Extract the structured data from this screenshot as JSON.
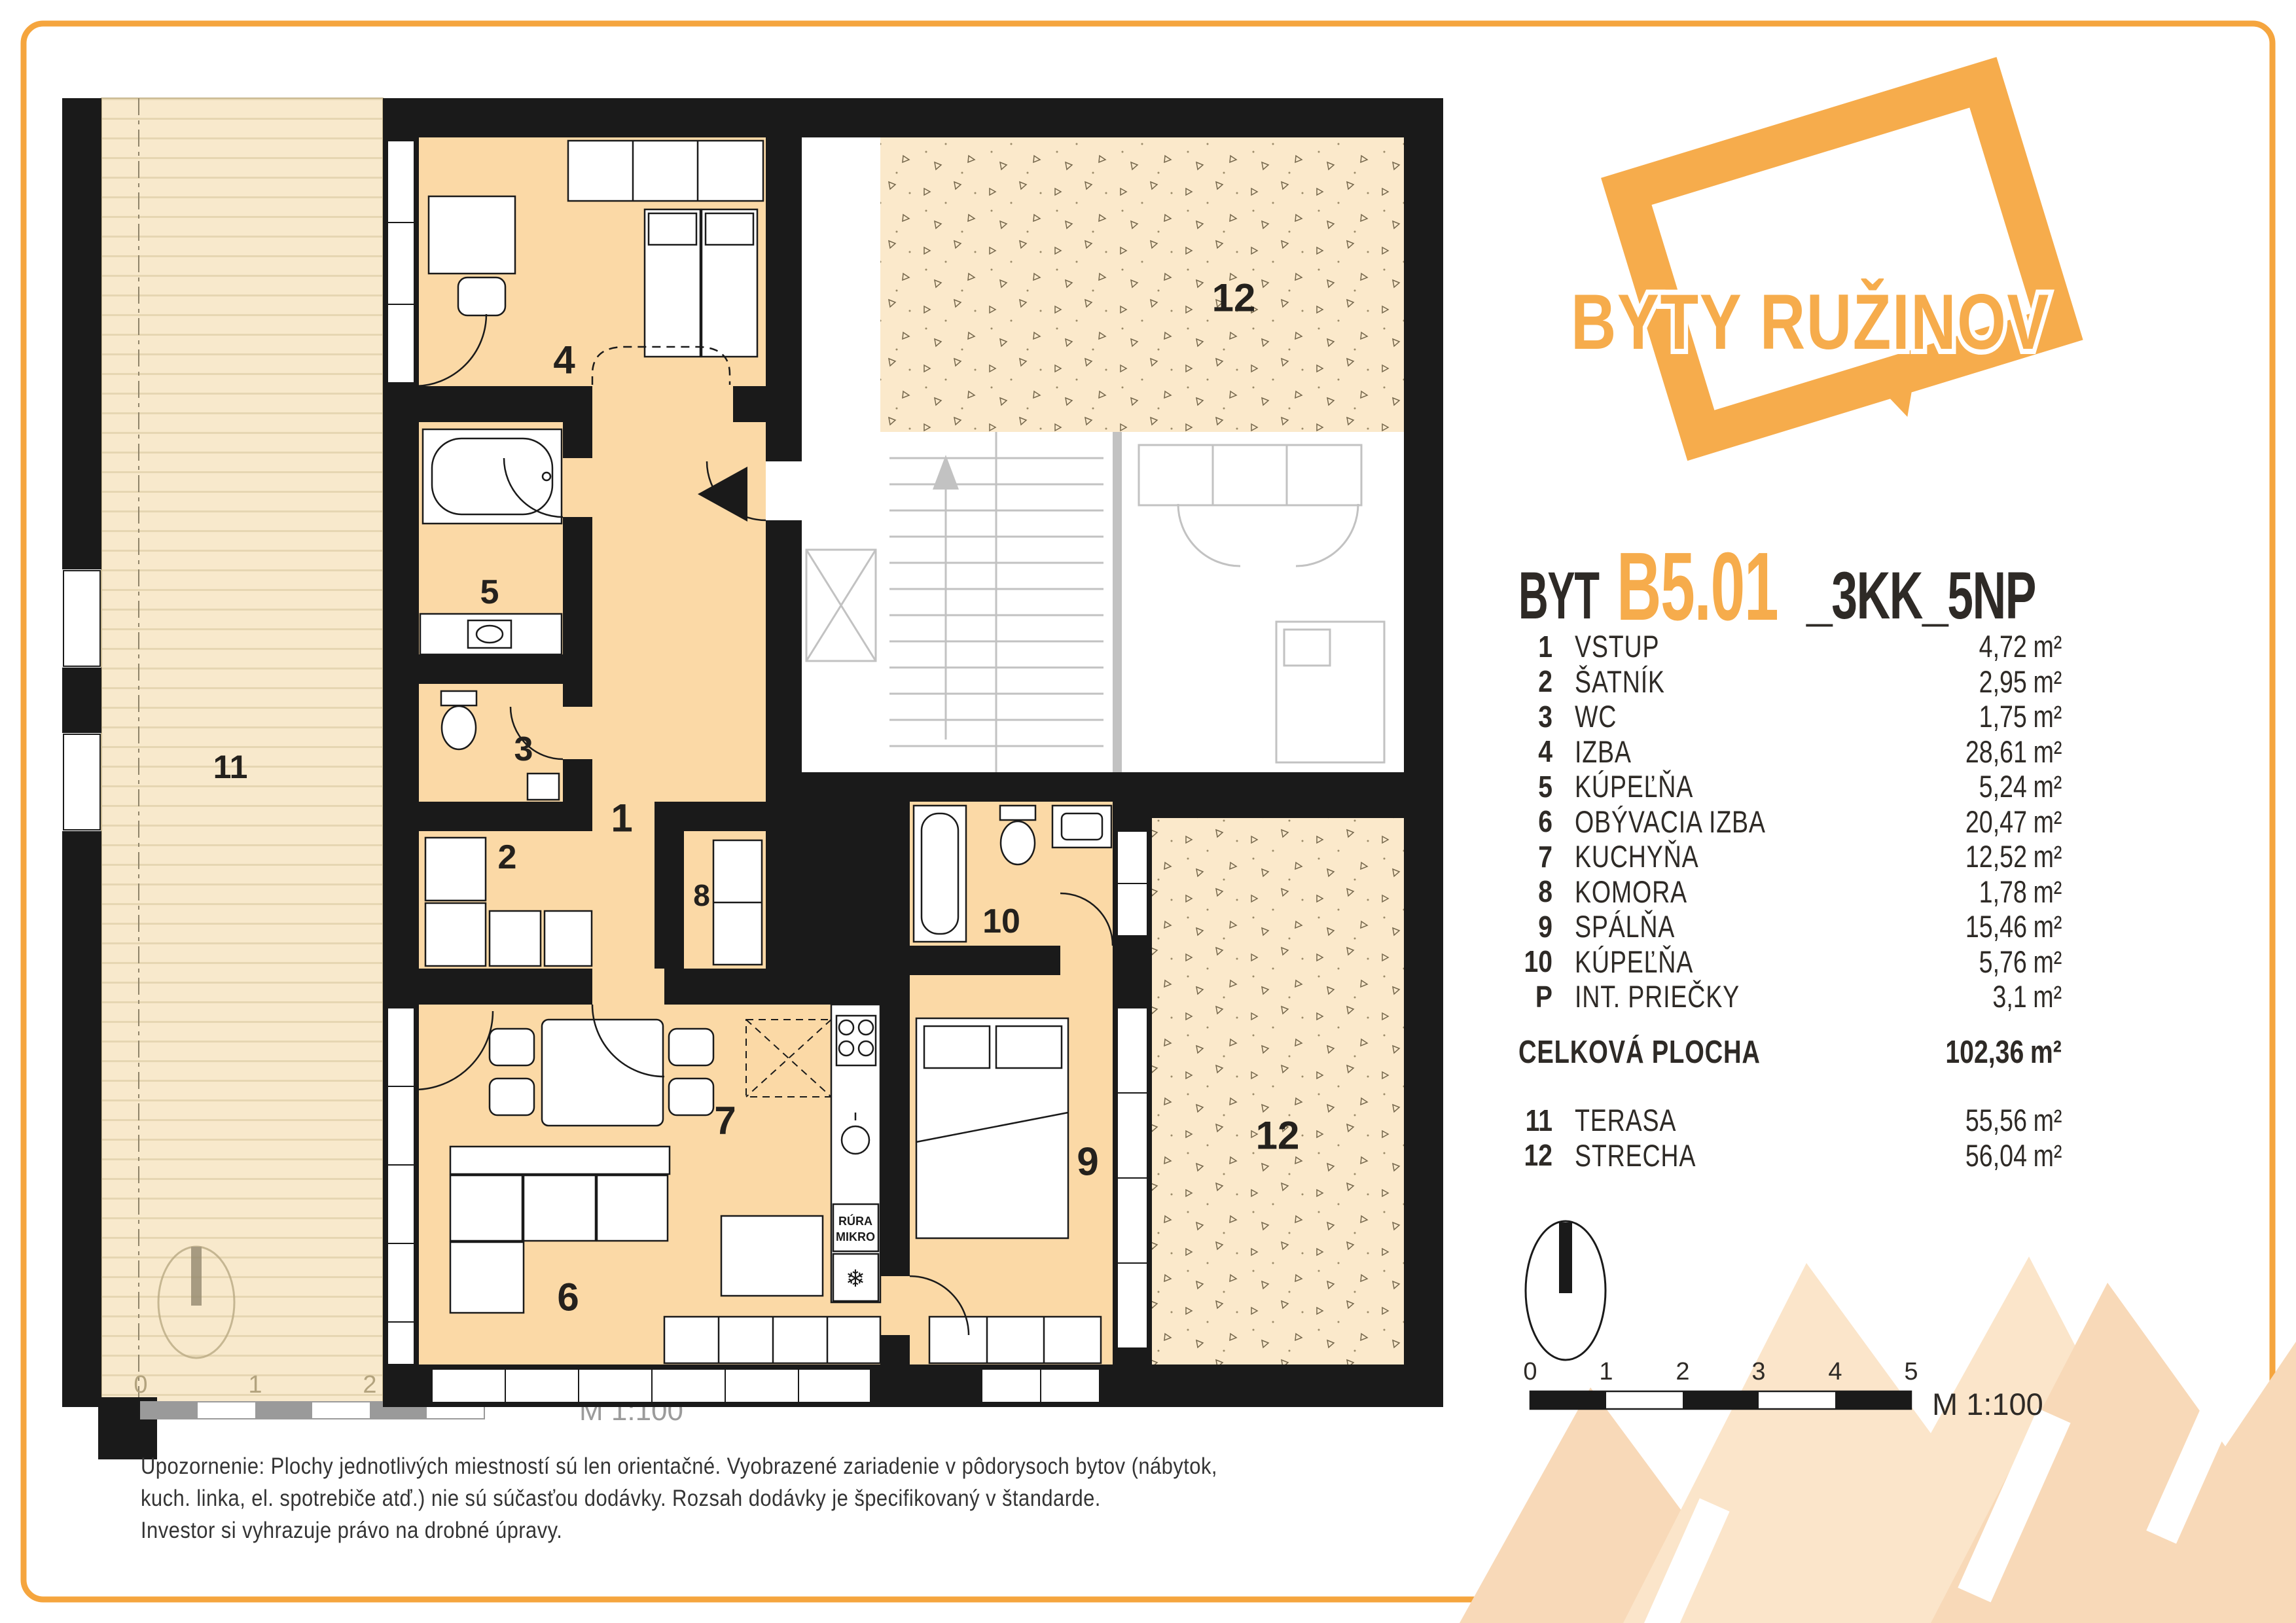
{
  "page": {
    "bg": "#ffffff",
    "border_color": "#F5A53E"
  },
  "logo": {
    "text": "BYTY RUŽINOV",
    "color": "#F6AC4C"
  },
  "title": {
    "prefix": "BYT",
    "code": "B5.01",
    "suffix": "_3KK_5NP"
  },
  "units": {
    "area": "m²"
  },
  "legend": {
    "rows": [
      {
        "num": "1",
        "name": "VSTUP",
        "area": "4,72"
      },
      {
        "num": "2",
        "name": "ŠATNÍK",
        "area": "2,95"
      },
      {
        "num": "3",
        "name": "WC",
        "area": "1,75"
      },
      {
        "num": "4",
        "name": "IZBA",
        "area": "28,61"
      },
      {
        "num": "5",
        "name": "KÚPEĽŇA",
        "area": "5,24"
      },
      {
        "num": "6",
        "name": "OBÝVACIA IZBA",
        "area": "20,47"
      },
      {
        "num": "7",
        "name": "KUCHYŇA",
        "area": "12,52"
      },
      {
        "num": "8",
        "name": "KOMORA",
        "area": "1,78"
      },
      {
        "num": "9",
        "name": "SPÁLŇA",
        "area": "15,46"
      },
      {
        "num": "10",
        "name": "KÚPEĽŇA",
        "area": "5,76"
      },
      {
        "num": "P",
        "name": "INT. PRIEČKY",
        "area": "3,1"
      }
    ],
    "total": {
      "label": "CELKOVÁ PLOCHA",
      "area": "102,36"
    },
    "outdoor": [
      {
        "num": "11",
        "name": "TERASA",
        "area": "55,56"
      },
      {
        "num": "12",
        "name": "STRECHA",
        "area": "56,04"
      }
    ]
  },
  "scalebar": {
    "ticks": [
      "0",
      "1",
      "2",
      "3",
      "4",
      "5"
    ],
    "label": "M 1:100"
  },
  "plan": {
    "labels": {
      "r1": "1",
      "r2": "2",
      "r3": "3",
      "r4": "4",
      "r5": "5",
      "r6": "6",
      "r7": "7",
      "r8": "8",
      "r9": "9",
      "r10": "10",
      "r11": "11",
      "r12": "12"
    },
    "kitchen": {
      "oven_line1": "RÚRA",
      "oven_line2": "MIKRO",
      "fridge_icon": "❄"
    },
    "faded_scale": {
      "ticks": [
        "0",
        "1",
        "2",
        "3"
      ],
      "label": "M 1:100"
    }
  },
  "footer": {
    "lines": [
      "Upozornenie: Plochy jednotlivých miestností sú len orientačné. Vyobrazené zariadenie v pôdorysoch bytov (nábytok,",
      "kuch. linka, el. spotrebiče atď.) nie sú súčasťou dodávky. Rozsah dodávky je špecifikovaný v štandarde.",
      "Investor si vyhrazuje právo na drobné úpravy."
    ]
  },
  "colors": {
    "accent": "#F6AC4C",
    "wall": "#1A1A1A",
    "room_fill": "#FBD9A6",
    "terrace_fill": "#F8E9CC",
    "roof_fill": "#FBE9CB",
    "core_gray": "#C2C2C2",
    "text_dark": "#2E2A26"
  }
}
